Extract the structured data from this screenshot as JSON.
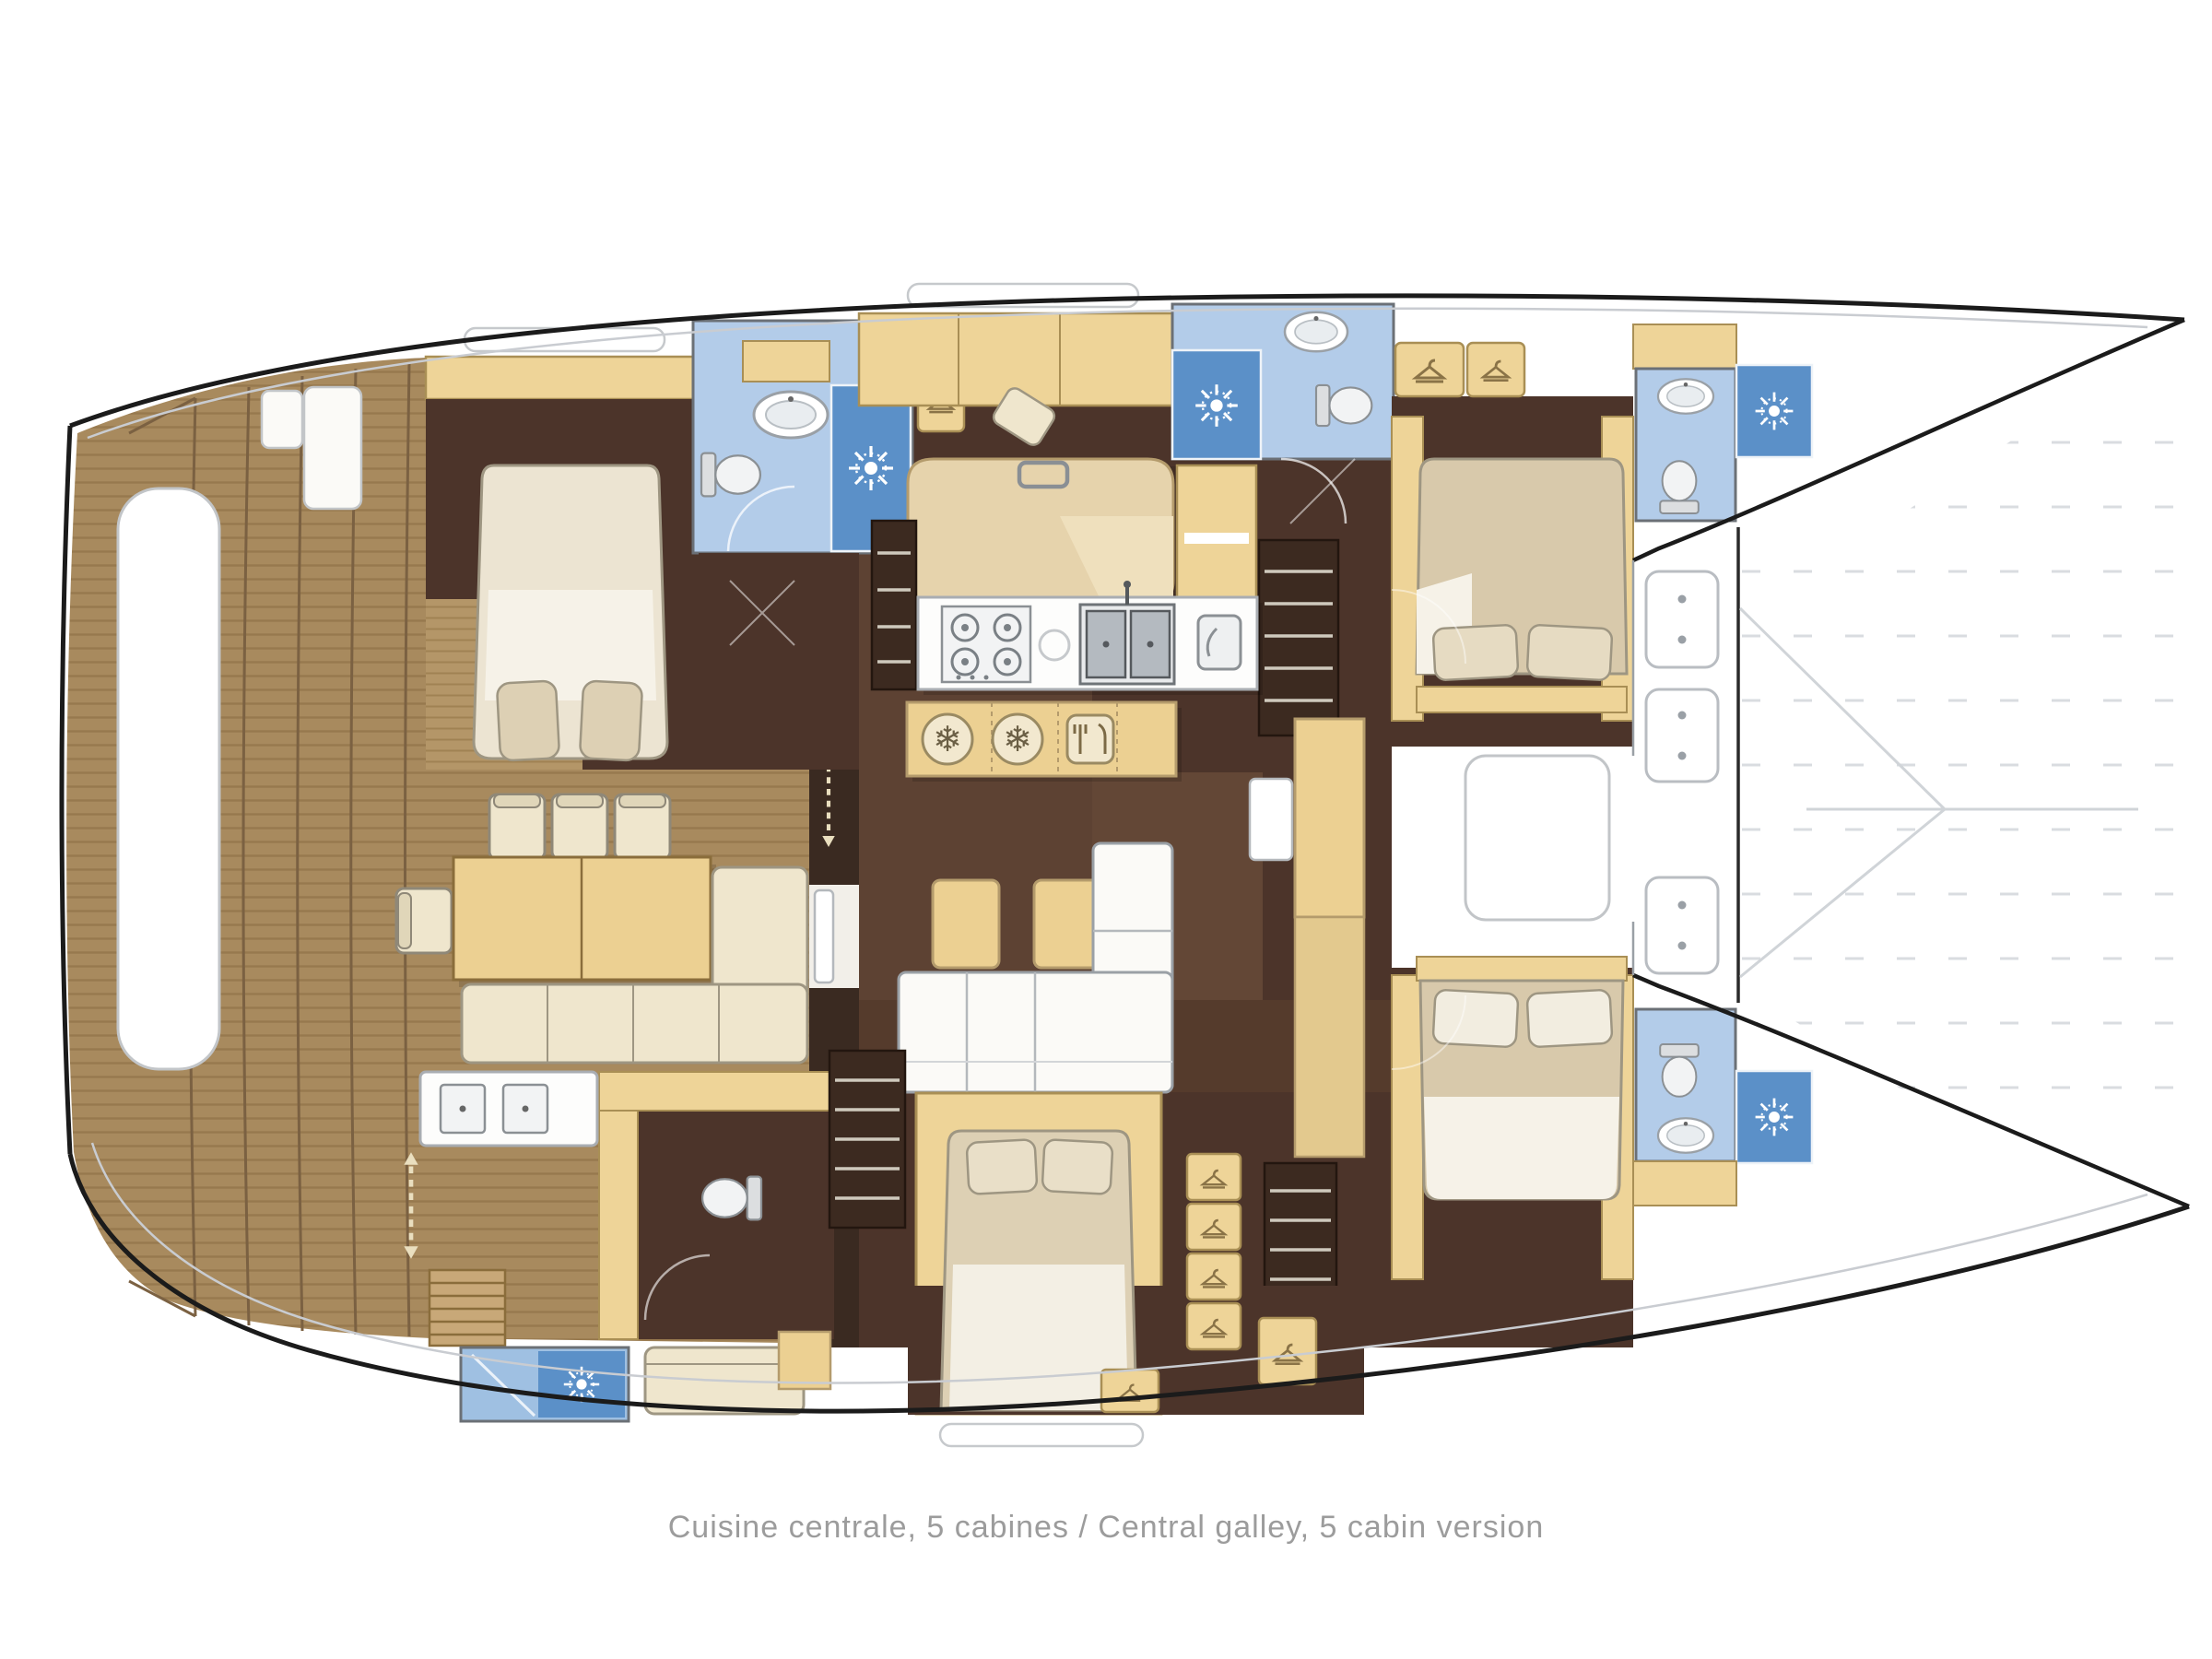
{
  "caption": {
    "full": "Cuisine centrale, 5 cabines / Central galley, 5 cabin version",
    "french": "Cuisine centrale, 5 cabines",
    "english": "Central galley, 5 cabin version"
  },
  "diagram": {
    "type": "yacht-floor-plan",
    "subject": "catamaran interior layout, bows to the right, two hulls with central galley saloon",
    "rooms": [
      {
        "name": "aft-cockpit-teak-deck",
        "side": "stern"
      },
      {
        "name": "port-aft-cabin",
        "features": [
          "double-bed",
          "wardrobe"
        ]
      },
      {
        "name": "port-aft-bathroom",
        "features": [
          "sink",
          "toilet",
          "shower"
        ]
      },
      {
        "name": "central-galley",
        "features": [
          "4-burner-stove",
          "double-sink",
          "oven",
          "fridge-island"
        ]
      },
      {
        "name": "saloon",
        "features": [
          "settee",
          "sofa",
          "poufs",
          "tall-cabinet"
        ]
      },
      {
        "name": "port-forward-bathroom",
        "features": [
          "sink",
          "toilet",
          "shower"
        ]
      },
      {
        "name": "port-bow-bathroom",
        "features": [
          "sink",
          "toilet",
          "shower"
        ]
      },
      {
        "name": "forward-cabin-port",
        "features": [
          "double-bed"
        ]
      },
      {
        "name": "forward-cabin-starboard",
        "features": [
          "double-bed"
        ]
      },
      {
        "name": "forward-cockpit",
        "features": [
          "deck-hatches",
          "seat-locker"
        ]
      },
      {
        "name": "starboard-aft-cabin",
        "features": [
          "double-bed",
          "bench",
          "wardrobes"
        ]
      },
      {
        "name": "starboard-day-head",
        "features": [
          "toilet",
          "twin-sink-vanity"
        ]
      },
      {
        "name": "starboard-bow-bathroom",
        "features": [
          "sink",
          "toilet",
          "shower"
        ]
      },
      {
        "name": "transom-shower",
        "features": [
          "shower"
        ]
      },
      {
        "name": "trampoline",
        "side": "bow"
      }
    ],
    "icon_glyphs": {
      "snowflake": "❄"
    },
    "icon_names": [
      "shower-sun-icon",
      "snowflake-fridge-icon",
      "hanger-wardrobe-icon",
      "cutlery-icon",
      "stove-burner-icon",
      "sink-icon",
      "toilet-icon",
      "stairs-icon",
      "direction-arrow-icon",
      "deck-hatch-icon"
    ],
    "counts": {
      "shower_sun_icons": 5,
      "snowflake_icons": 2,
      "hanger_icons": 9,
      "toilets": 5,
      "stove_burners": 4,
      "double_beds": 4
    },
    "palette": {
      "hull_outline": "#1b1b1b",
      "faint_line": "#c9ccd1",
      "teak_deck": "#a88a5e",
      "plank_line": "#8f744c",
      "dark_floor": "#4c342a",
      "floor_panel": "#5d4233",
      "furniture_yellow": "#eed498",
      "furniture_cream": "#efe6cd",
      "bed_beige": "#d8c9ab",
      "bed_cream": "#ece4d2",
      "bath_blue": "#b3cce9",
      "shower_blue": "#5b90c8",
      "fixture_white": "#f4f5f6",
      "caption_gray": "#9c9c9c"
    }
  }
}
